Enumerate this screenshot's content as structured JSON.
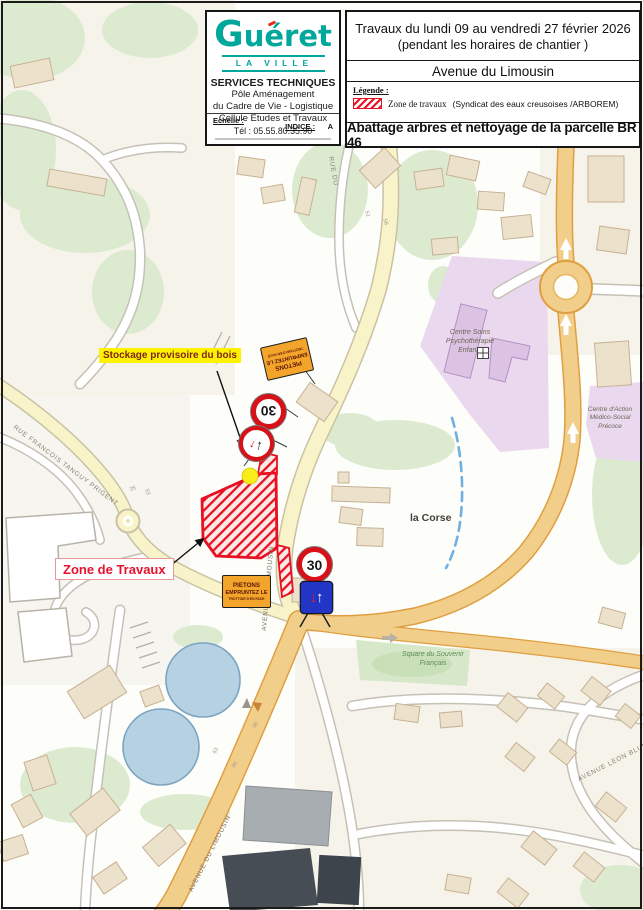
{
  "sheet": {
    "logo": {
      "city": "Guéret",
      "tagline": "LA VILLE",
      "org": "SERVICES TECHNIQUES",
      "org_line2": "Pôle Aménagement",
      "org_line3": "du Cadre de Vie - Logistique",
      "org_line4": "Cellule Etudes et Travaux",
      "phone": "Tél : 05.55.80.35.90",
      "scale_label": "Echelle :",
      "index_label": "INDICE :",
      "index_value": "A"
    },
    "header": {
      "title_line1": "Travaux du lundi 09 au vendredi 27 février 2026",
      "title_line2": "(pendant les horaires de chantier )",
      "street_title": "Avenue du Limousin",
      "legend_label": "Légende :",
      "legend_item_label": "Zone de travaux",
      "legend_item_detail": "(Syndicat des eaux creusoises /ARBOREM)",
      "work_title": "Abattage arbres et nettoyage de la parcelle BR 46"
    }
  },
  "annotations": {
    "storage_label": "Stockage provisoire du bois",
    "work_zone_label": "Zone de Travaux"
  },
  "signs": {
    "speed_limit": "30",
    "pedestrian_line1": "PIETONS",
    "pedestrian_line2": "EMPRUNTEZ LE",
    "pedestrian_line3": "TROTTOIR D'EN FACE"
  },
  "map": {
    "streets": {
      "rue_du": "RUE DU",
      "rue_tanguy": "RUE FRANCOIS TANGUY PRIGENT",
      "avenue_limousin": "AVENUE DU LIMOUSIN",
      "avenue_leon_blum": "AVENUE LEON BLUM"
    },
    "places": {
      "la_corse": "la Corse",
      "centre_soins_1": "Centre Soins",
      "centre_soins_2": "Psychothérapie",
      "centre_soins_3": "Enfants",
      "centre_action_1": "Centre d'Action",
      "centre_action_2": "Médico-Social",
      "centre_action_3": "Précoce",
      "square_1": "Square du Souvenir",
      "square_2": "Français"
    },
    "house_numbers": [
      "35",
      "53",
      "51",
      "56",
      "63",
      "96",
      "90"
    ]
  },
  "colors": {
    "logo_teal": "#00a79b",
    "work_red": "#e8112d",
    "sign_orange": "#f2a52a",
    "sign_blue": "#2235c5",
    "highlight_yellow": "#fff200",
    "road_yellow": "#f8f3c8",
    "road_orange": "#f2ce8b",
    "zone_purple": "#ead9ee",
    "pond_blue": "#b6d1e1"
  }
}
